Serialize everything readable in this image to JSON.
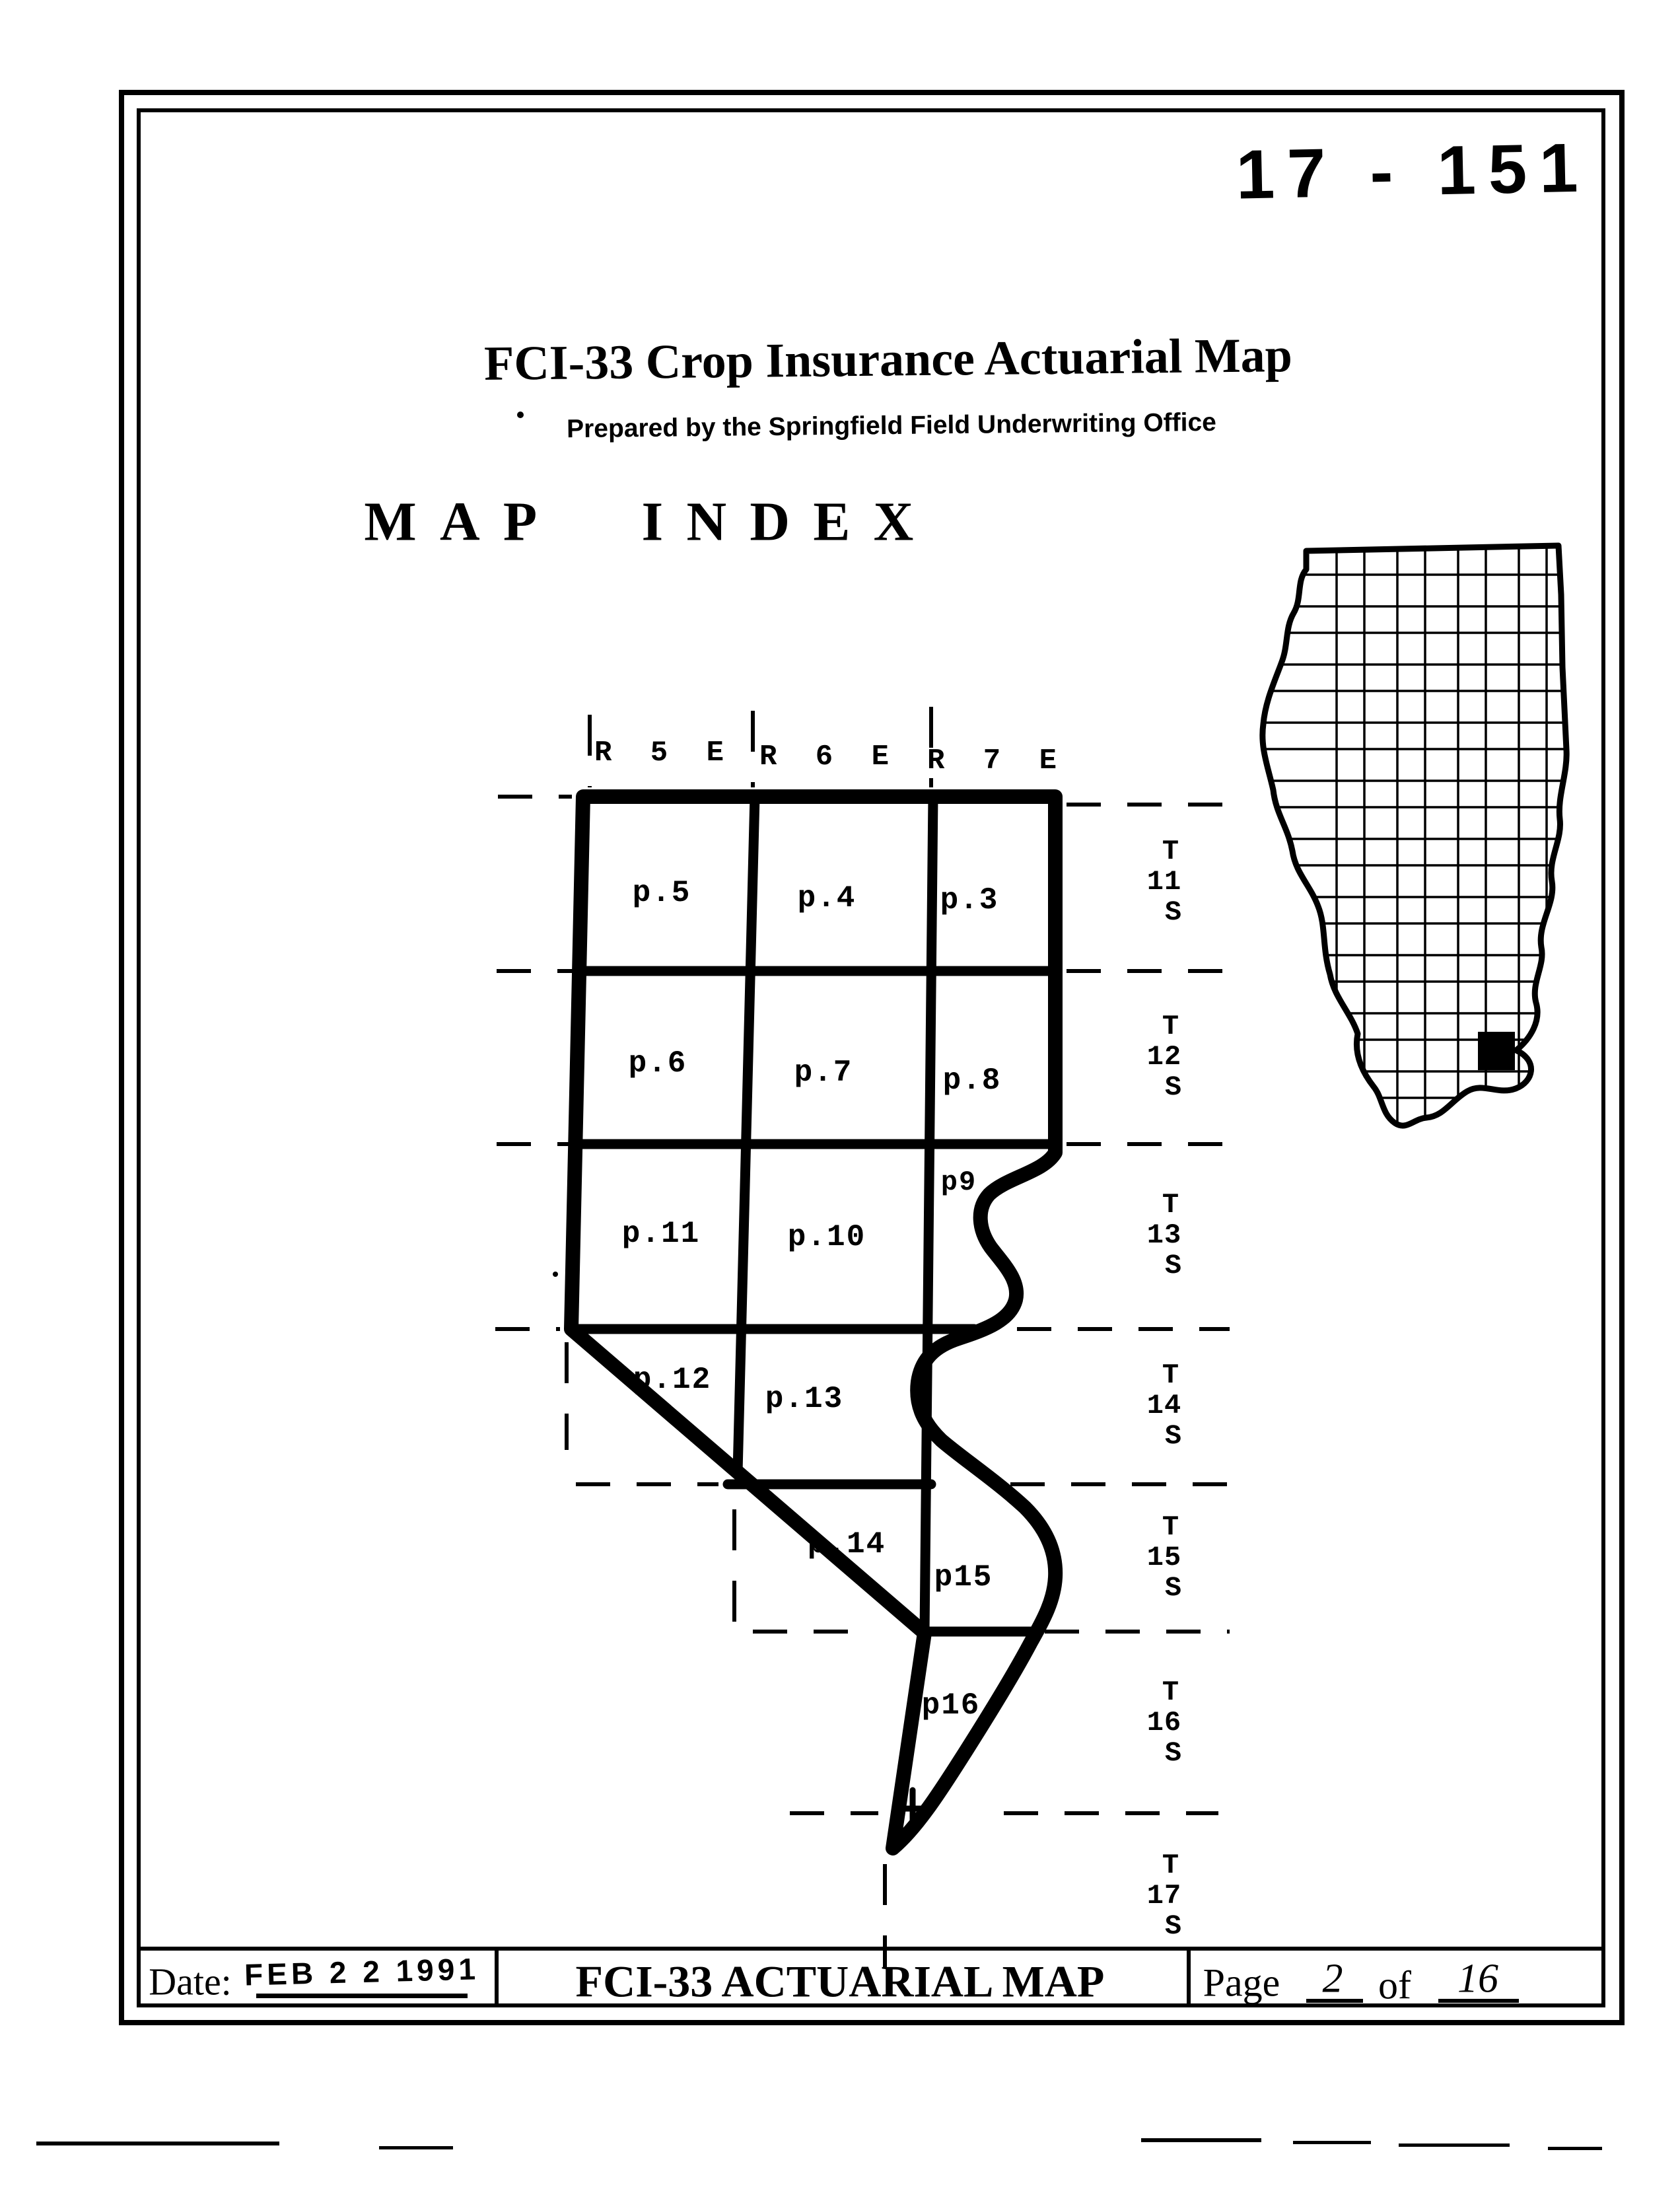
{
  "colors": {
    "ink": "#000000",
    "paper": "#ffffff"
  },
  "stamp_number": "17 - 151",
  "header": {
    "title": "FCI-33 Crop Insurance Actuarial Map",
    "subtitle": "Prepared by the Springfield Field Underwriting Office",
    "index_heading": "MAP INDEX"
  },
  "map_index": {
    "ranges": [
      "R 5 E",
      "R 6 E",
      "R 7 E"
    ],
    "townships": [
      {
        "t": "T",
        "n": "11",
        "s": "S"
      },
      {
        "t": "T",
        "n": "12",
        "s": "S"
      },
      {
        "t": "T",
        "n": "13",
        "s": "S"
      },
      {
        "t": "T",
        "n": "14",
        "s": "S"
      },
      {
        "t": "T",
        "n": "15",
        "s": "S"
      },
      {
        "t": "T",
        "n": "16",
        "s": "S"
      },
      {
        "t": "T",
        "n": "17",
        "s": "S"
      }
    ],
    "page_cells": [
      "p.5",
      "p.4",
      "p.3",
      "p.6",
      "p.7",
      "p.8",
      "p9",
      "p.11",
      "p.10",
      "p.12",
      "p.13",
      "p.14",
      "p15",
      "p16"
    ]
  },
  "footer": {
    "date_label": "Date:",
    "date_stamp": "FEB 2 2 1991",
    "center_title": "FCI-33 ACTUARIAL MAP",
    "page_label": "Page",
    "page_number": "2",
    "of_label": "of",
    "page_total": "16"
  }
}
